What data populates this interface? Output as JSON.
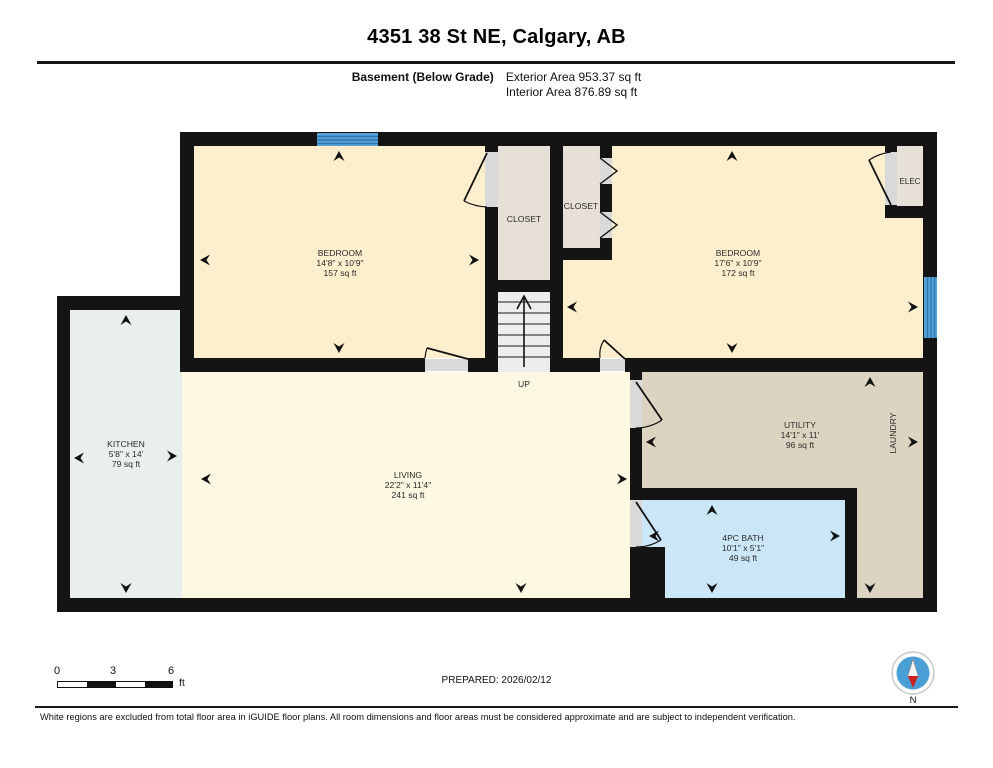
{
  "header": {
    "title": "4351 38 St NE, Calgary, AB",
    "floor_label": "Basement (Below Grade)",
    "exterior_area": "Exterior Area 953.37 sq ft",
    "interior_area": "Interior Area 876.89 sq ft"
  },
  "rooms": [
    {
      "name": "BEDROOM",
      "dims": "14'8\" x 10'9\"",
      "area": "157 sq ft"
    },
    {
      "name": "BEDROOM",
      "dims": "17'6\" x 10'9\"",
      "area": "172 sq ft"
    },
    {
      "name": "KITCHEN",
      "dims": "5'8\" x 14'",
      "area": "79 sq ft"
    },
    {
      "name": "LIVING",
      "dims": "22'2\" x 11'4\"",
      "area": "241 sq ft"
    },
    {
      "name": "UTILITY",
      "dims": "14'1\" x 11'",
      "area": "96 sq ft"
    },
    {
      "name": "4PC BATH",
      "dims": "10'1\" x 5'1\"",
      "area": "49 sq ft"
    },
    {
      "name": "CLOSET"
    },
    {
      "name": "CLOSET"
    },
    {
      "name": "ELEC"
    },
    {
      "name": "LAUNDRY"
    },
    {
      "name": "UP"
    }
  ],
  "scale_bar": {
    "tick_0": "0",
    "tick_3": "3",
    "tick_6": "6",
    "unit": "ft"
  },
  "footer": {
    "prepared": "PREPARED: 2026/02/12",
    "disclaimer": "White regions are excluded from total floor area in iGUIDE floor plans. All room dimensions and floor areas must be considered approximate and are subject to independent verification.",
    "compass_label": "N"
  },
  "colors": {
    "bedroom": "#fdeecd",
    "living": "#fdf8e2",
    "kitchen": "#e8efec",
    "closet": "#e7e0d8",
    "stairs": "#ededed",
    "utility": "#ddd3c1",
    "bath": "#cbe7f7",
    "window": "#56a3d9",
    "wall": "#141414",
    "door_jamb": "#d9d9d9",
    "compass_blue": "#4a9ed6",
    "compass_red": "#cf2020"
  }
}
